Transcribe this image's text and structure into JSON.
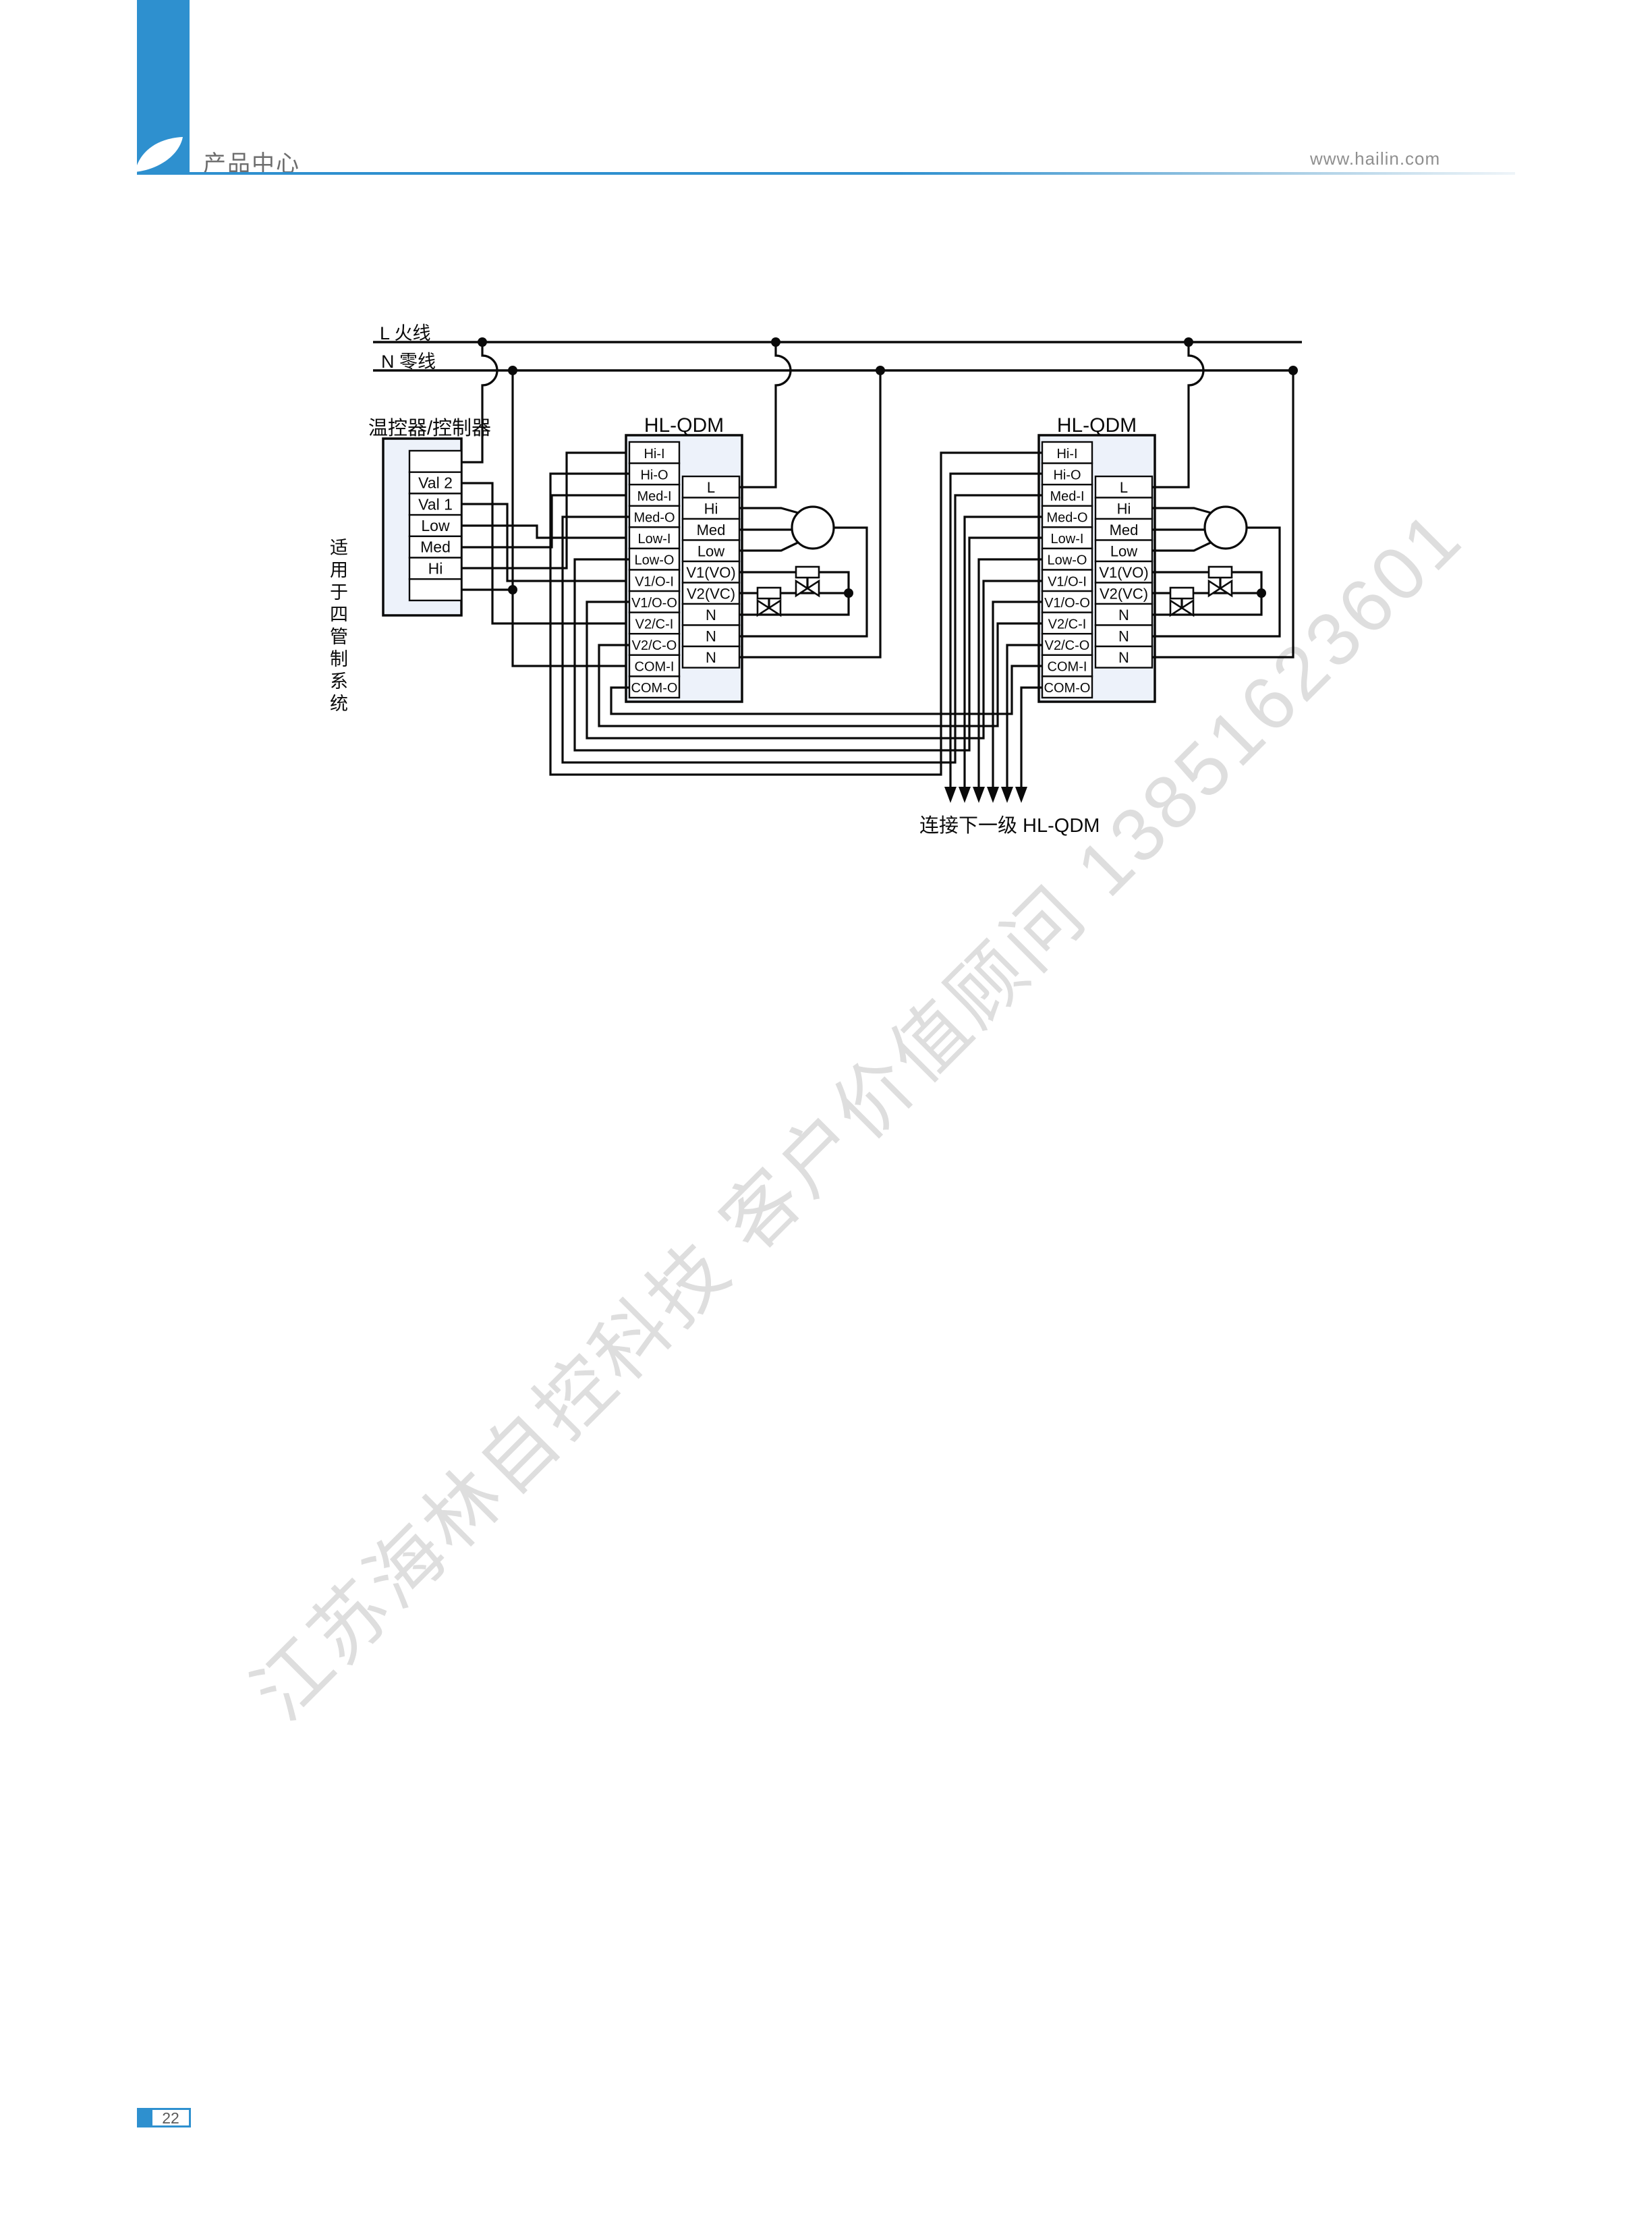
{
  "header": {
    "title": "产品中心",
    "url": "www.hailin.com"
  },
  "colors": {
    "accent": "#2e90cf",
    "watermark": "#dedede",
    "wire": "#0a0a0a",
    "module_fill": "#edf2fa"
  },
  "watermark": {
    "text": "江苏海林自控科技 客户价值顾问 13851623601"
  },
  "page": {
    "number": "22"
  },
  "diagram": {
    "side_note": "适用于四管制系统",
    "bus": {
      "live": "L 火线",
      "neutral": "N 零线"
    },
    "controller": {
      "title": "温控器/控制器",
      "cells": [
        "",
        "Val 2",
        "Val 1",
        "Low",
        "Med",
        "Hi",
        ""
      ]
    },
    "module_title": "HL-QDM",
    "left_terminals": [
      "Hi-I",
      "Hi-O",
      "Med-I",
      "Med-O",
      "Low-I",
      "Low-O",
      "V1/O-I",
      "V1/O-O",
      "V2/C-I",
      "V2/C-O",
      "COM-I",
      "COM-O"
    ],
    "right_terminals": [
      "L",
      "Hi",
      "Med",
      "Low",
      "V1(VO)",
      "V2(VC)",
      "N",
      "N",
      "N"
    ],
    "next_label": "连接下一级 HL-QDM"
  }
}
